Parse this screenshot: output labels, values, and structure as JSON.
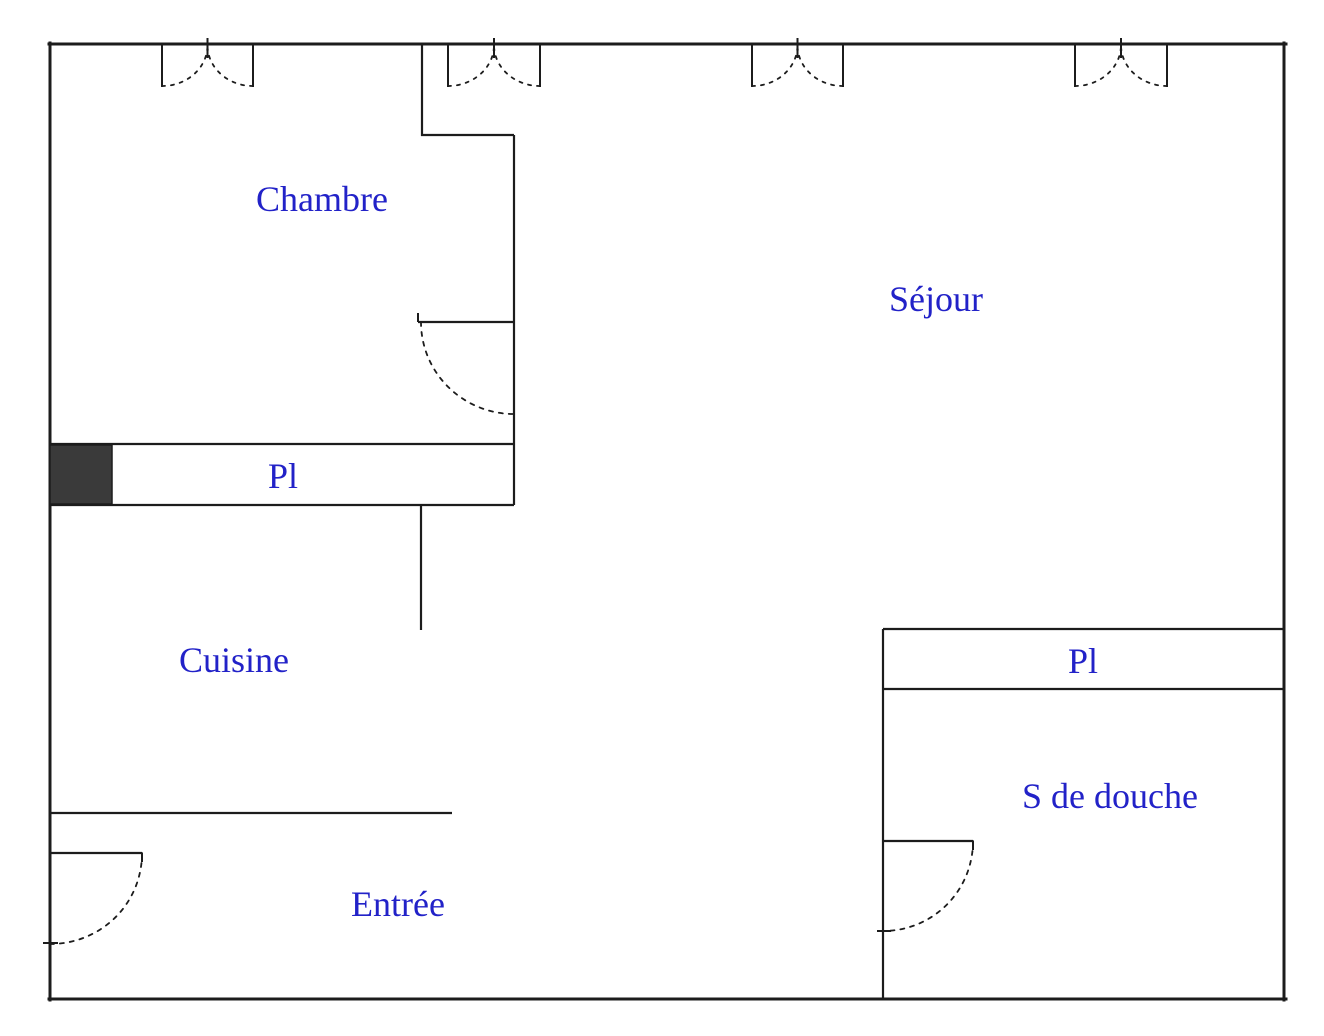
{
  "plan": {
    "kind": "apartment-floor-plan",
    "language": "fr"
  },
  "colors": {
    "background": "#ffffff",
    "wall": "#1c1c1c",
    "label_text": "#2222c8",
    "closet_block_fill": "#3a3a3a"
  },
  "rooms": {
    "chambre": {
      "label": "Chambre"
    },
    "sejour": {
      "label": "Séjour"
    },
    "cuisine": {
      "label": "Cuisine"
    },
    "entree": {
      "label": "Entrée"
    },
    "salle_de_douche": {
      "label": "S de douche"
    },
    "placard_chambre": {
      "label": "Pl"
    },
    "placard_douche": {
      "label": "Pl"
    }
  }
}
